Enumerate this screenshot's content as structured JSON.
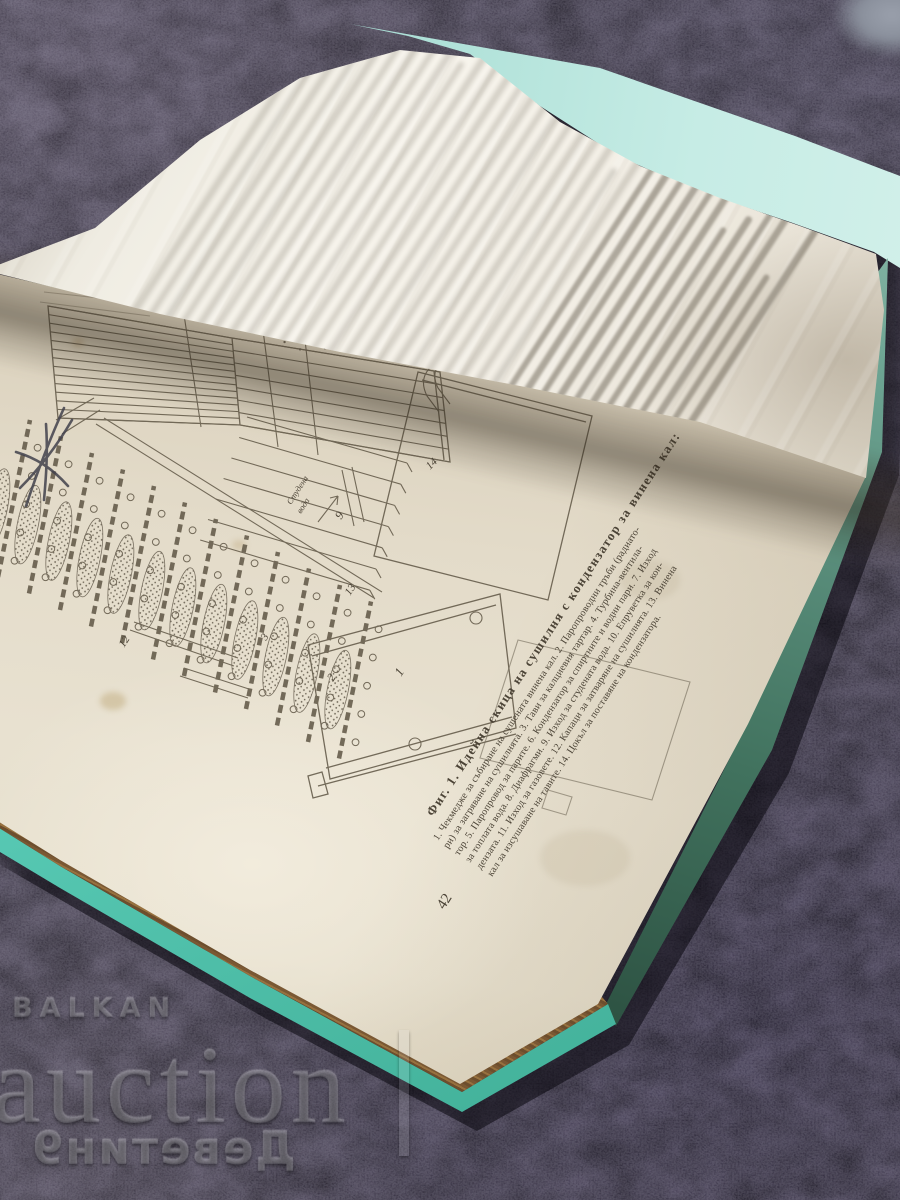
{
  "book": {
    "page_number": "42",
    "figure_caption": {
      "heading": "Фиг. 1. Идейна скица на сушилня с кондензатор за винена кал:",
      "legend_lines": [
        "1. Чекмедже за събиране на сушената винена кал. 2. Паропроводни тръби (радиато-",
        "ри) за загряване на сушилнята. 3. Тави за калциевия тартар. 4. Турбина-вентила-",
        "тор. 5. Паропровод за парите. 6. Кондензатор за спиртните и водни пари. 7. Изход",
        "за топлата вода. 8. Диафрагми. 9. Изход за студената вода. 10. Епруветка за кон-",
        "дензата. 11. Изход за газовете. 12. Капаци за затваряне на сушилнята. 13. Винена",
        "кал за изсушаване на тавите. 14. Цокъл за поставяне на кондензатора."
      ]
    },
    "diagram_labels": {
      "cold_water_line1": "Студена",
      "cold_water_line2": "вода",
      "n1": "1",
      "n2": "2",
      "n3": "3",
      "n9": "9",
      "n12": "12",
      "n13": "13",
      "n14": "14"
    }
  },
  "watermark": {
    "brand_top": "BALKAN",
    "brand_main": "auction",
    "brand_bottom": "Деветин9"
  },
  "colors": {
    "cover_teal": "#5accb7",
    "cover_dark_green": "#2a4d3e",
    "page_cream": "#e6dfcd",
    "page_edge_brown": "#7a5833",
    "carpet": "#2e2a36",
    "ink": "#5a5244"
  }
}
